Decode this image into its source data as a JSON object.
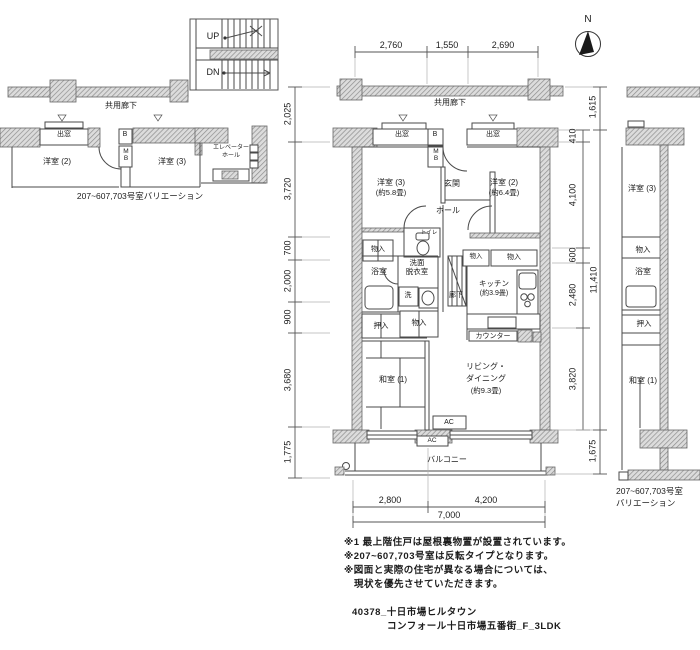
{
  "compass": {
    "north": "N"
  },
  "stairs": {
    "up": "UP",
    "dn": "DN"
  },
  "corridor": {
    "left_label": "共用廊下",
    "center_label": "共用廊下"
  },
  "left_variation": {
    "bay_window": "出窓",
    "western2": "洋室 (2)",
    "duct": "B",
    "meter_box": "MB",
    "western3": "洋室 (3)",
    "elevator_line1": "エレベーター",
    "elevator_line2": "ホール",
    "caption": "207~607,703号室バリエーション"
  },
  "main": {
    "bay_left": "出窓",
    "bay_right": "出窓",
    "duct": "B",
    "meter_box": "MB",
    "entrance": "玄関",
    "western3": "洋室 (3)",
    "western3_size": "(約5.8畳)",
    "western2": "洋室 (2)",
    "western2_size": "(約6.4畳)",
    "hall": "ホール",
    "toilet": "トイレ",
    "storage_nw": "物入",
    "bath": "浴室",
    "washroom_line1": "洗面",
    "washroom_line2": "脱衣室",
    "washer": "洗",
    "corridor": "廊下",
    "storage_k1": "物入",
    "storage_k2": "物入",
    "kitchen": "キッチン",
    "kitchen_size": "(約3.9畳)",
    "counter": "カウンター",
    "oshiire": "押入",
    "storage_mid": "物入",
    "washitsu": "和室 (1)",
    "living_line1": "リビング・",
    "living_line2": "ダイニング",
    "living_size": "(約9.3畳)",
    "ac1": "AC",
    "ac2": "AC",
    "balcony": "バルコニー"
  },
  "right_variation": {
    "western3": "洋室 (3)",
    "storage": "物入",
    "bath": "浴室",
    "oshiire": "押入",
    "washitsu": "和室 (1)",
    "caption_line1": "207~607,703号室",
    "caption_line2": "バリエーション"
  },
  "dims": {
    "top": [
      "2,760",
      "1,550",
      "2,690"
    ],
    "bottom": [
      "2,800",
      "4,200",
      "7,000"
    ],
    "left": [
      "2,025",
      "3,720",
      "700",
      "2,000",
      "900",
      "3,680",
      "1,775"
    ],
    "right_inner": [
      "410",
      "4,100",
      "600",
      "2,480",
      "3,820"
    ],
    "right_outer": [
      "1,615",
      "11,410",
      "1,675"
    ]
  },
  "notes": [
    "※1 最上階住戸は屋根裏物置が設置されています。",
    "※207~607,703号室は反転タイプとなります。",
    "※図面と実際の住宅が異なる場合については、",
    "　現状を優先させていただきます。"
  ],
  "footer": [
    "40378_十日市場ヒルタウン",
    "コンフォール十日市場五番街_F_3LDK"
  ]
}
